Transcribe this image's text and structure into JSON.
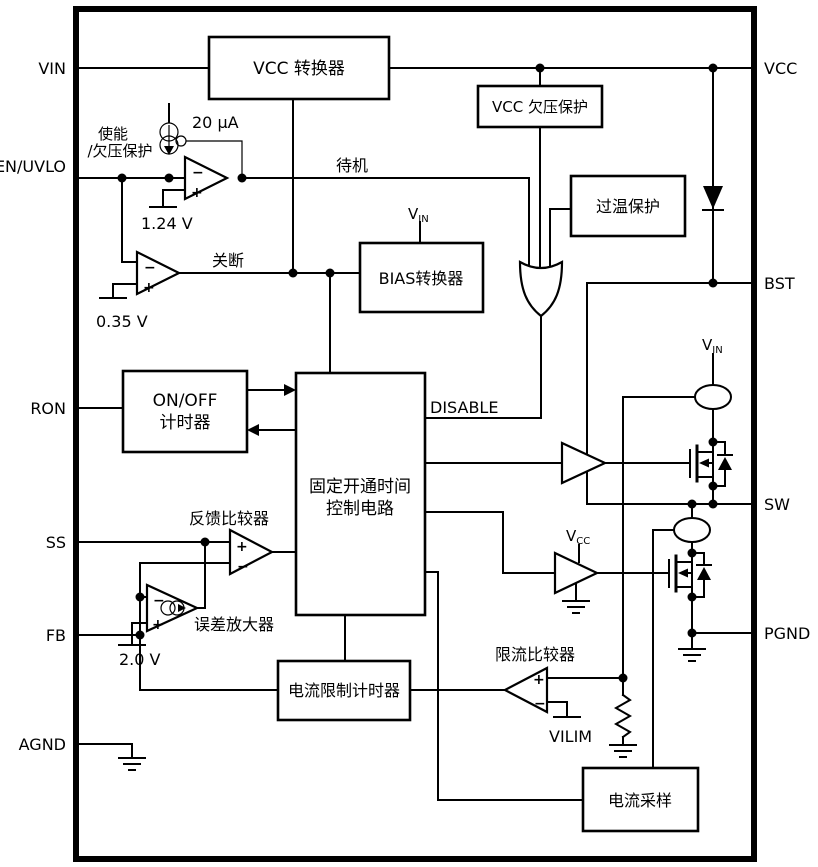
{
  "pins": {
    "left": [
      "VIN",
      "EN/UVLO",
      "RON",
      "SS",
      "FB",
      "AGND"
    ],
    "right": [
      "VCC",
      "BST",
      "SW",
      "PGND"
    ]
  },
  "blocks": {
    "vcc_converter": "VCC 转换器",
    "vcc_uvp": "VCC 欠压保护",
    "otp": "过温保护",
    "bias_converter": "BIAS转换器",
    "on_off_timer": [
      "ON/OFF",
      "计时器"
    ],
    "cot_control": [
      "固定开通时间",
      "控制电路"
    ],
    "ilim_timer": "电流限制计时器",
    "current_sense": "电流采样"
  },
  "labels": {
    "enable_uvlo": [
      "使能",
      "/欠压保护"
    ],
    "bias_current": "20 µA",
    "vref_en": "1.24 V",
    "vref_shutdown": "0.35 V",
    "standby": "待机",
    "shutdown": "关断",
    "disable": "DISABLE",
    "fb_comparator": "反馈比较器",
    "error_amp": "误差放大器",
    "vref_ea": "2.0 V",
    "ilim_comparator": "限流比较器",
    "vilim": "VILIM",
    "v": "V",
    "sub_in": "IN",
    "sub_cc": "CC",
    "plus": "+",
    "minus": "−"
  },
  "colors": {
    "line": "#000000",
    "background": "#ffffff"
  }
}
